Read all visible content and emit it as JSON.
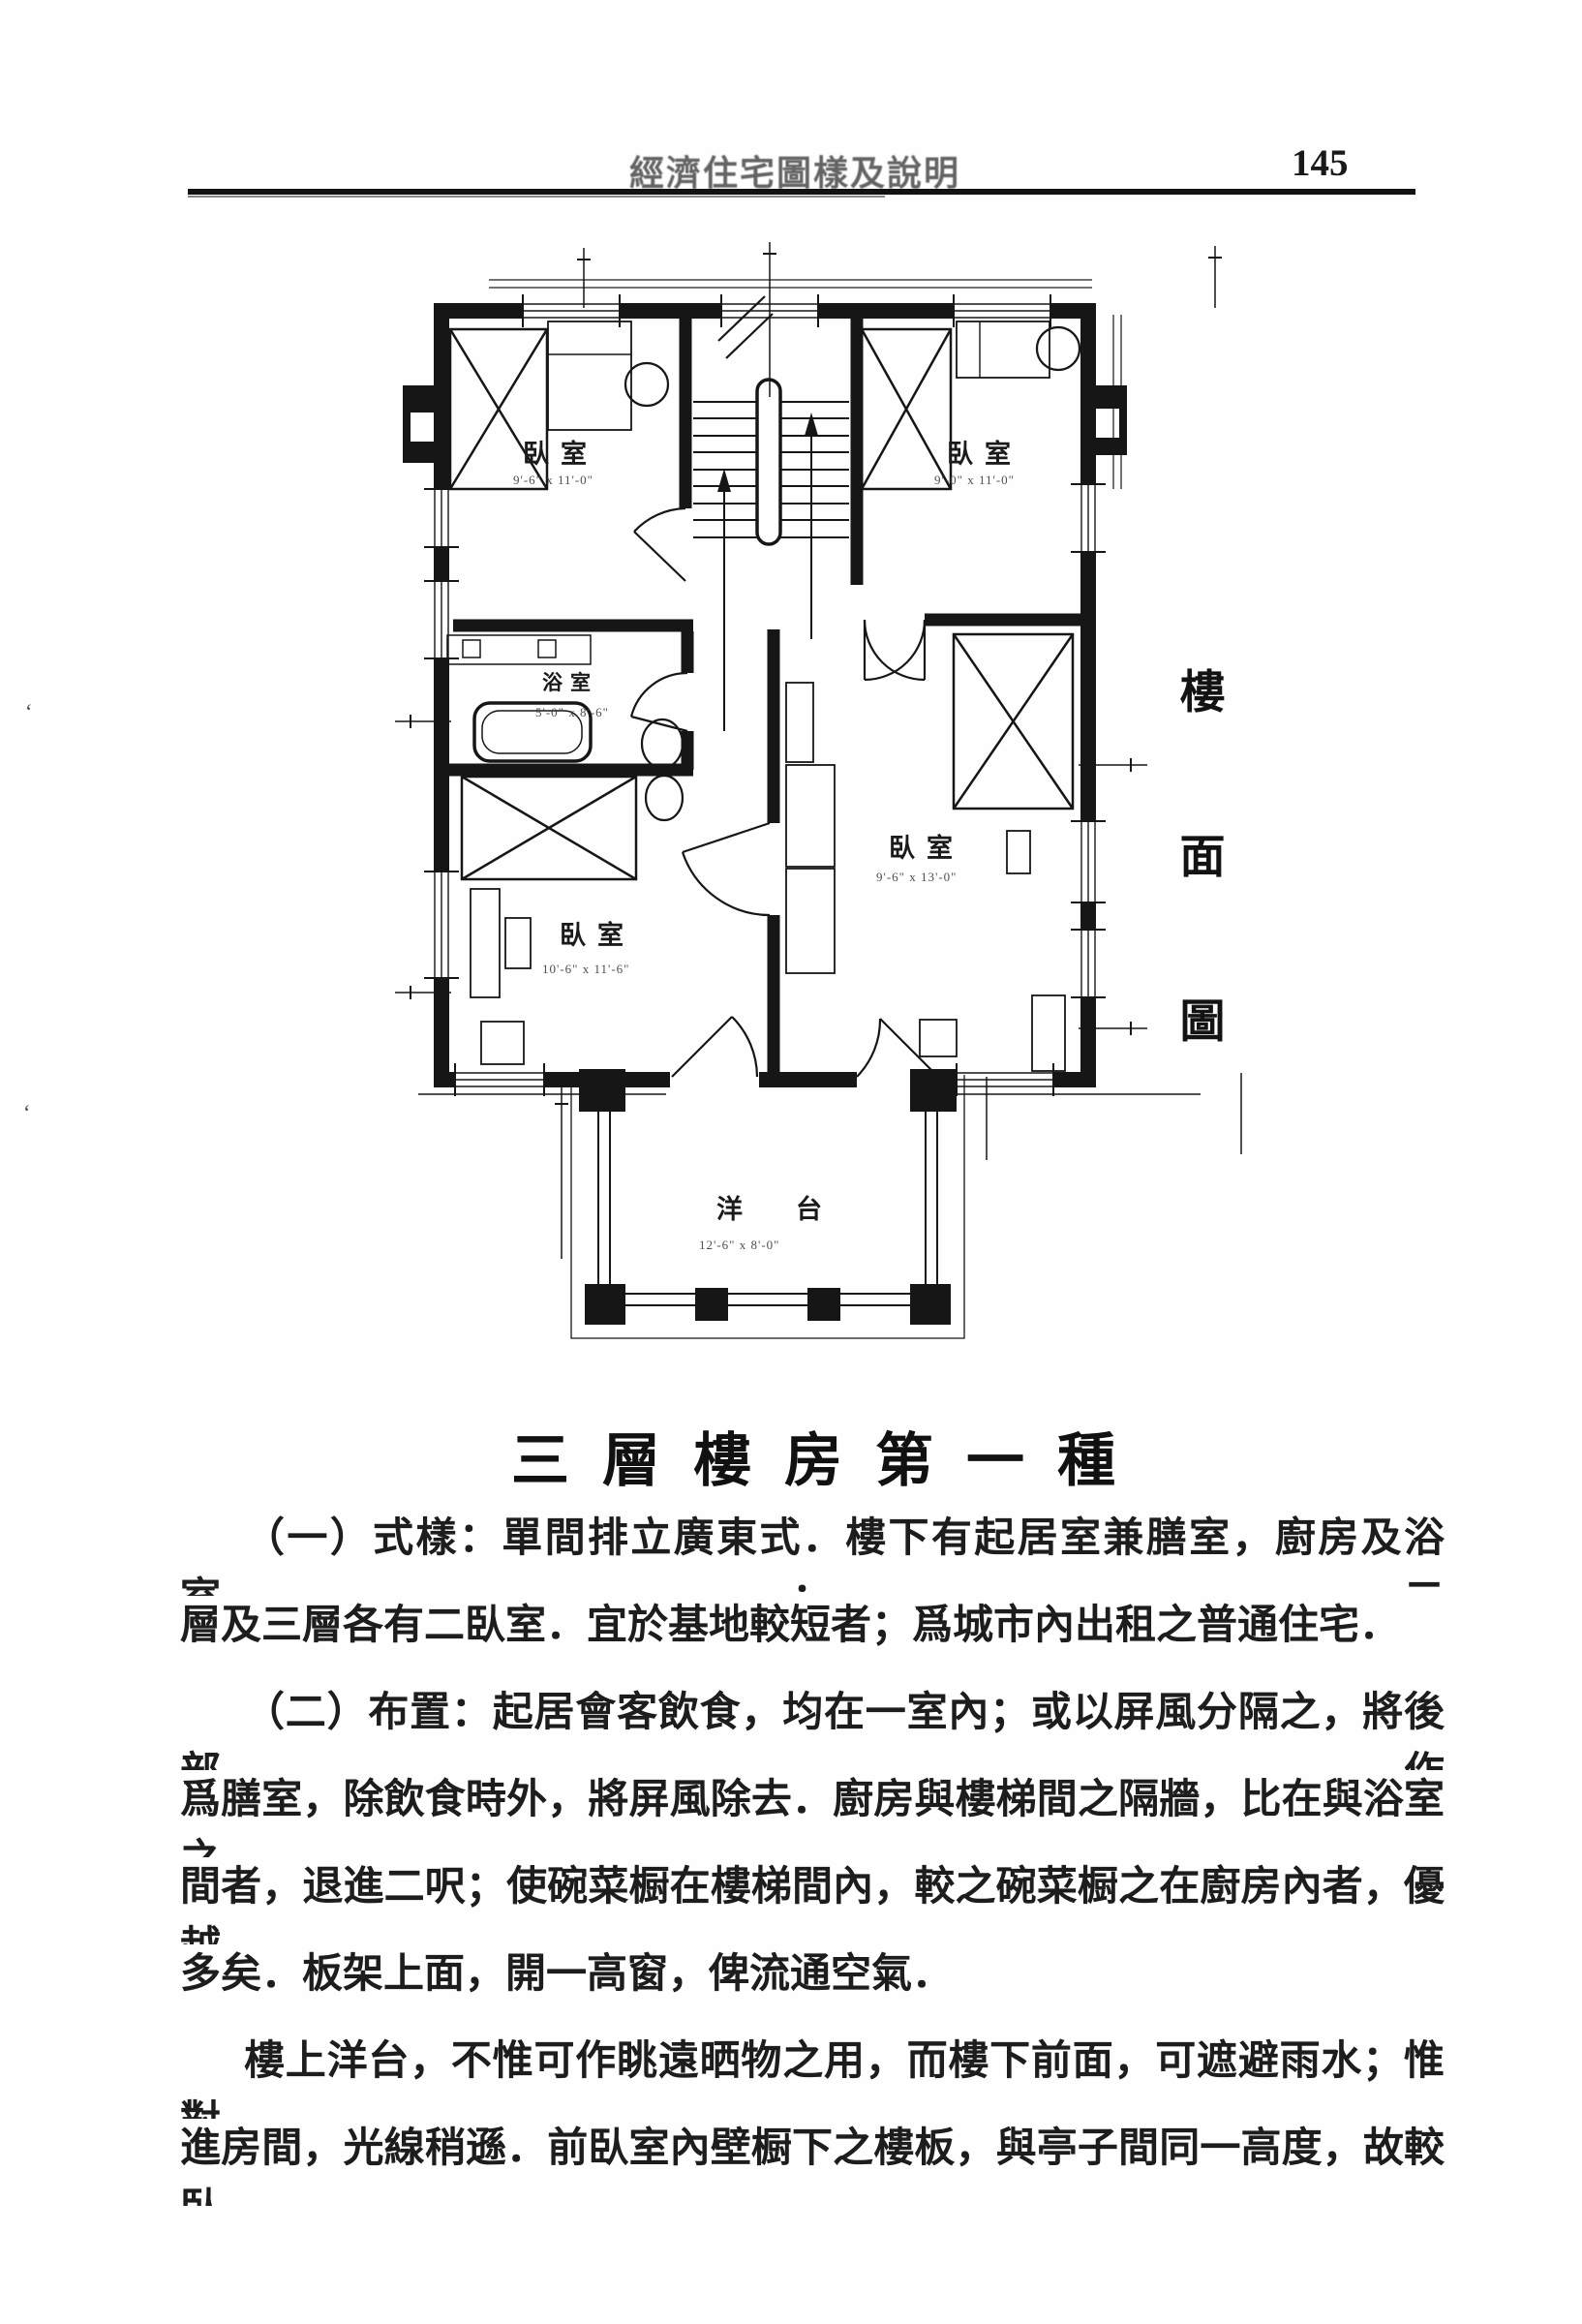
{
  "page": {
    "header_title": "經濟住宅圖樣及說明",
    "page_number": "145"
  },
  "side_caption": {
    "char1": "樓",
    "char2": "面",
    "char3": "圖"
  },
  "section_heading": "三層樓房第一種",
  "body": {
    "lines": [
      "（一）式樣：單間排立廣東式．樓下有起居室兼膳室，廚房及浴室；二",
      "層及三層各有二臥室．宜於基地較短者；爲城市內出租之普通住宅．",
      "（二）布置：起居會客飲食，均在一室內；或以屏風分隔之，將後部作",
      "爲膳室，除飲食時外，將屏風除去．廚房與樓梯間之隔牆，比在與浴室之",
      "間者，退進二呎；使碗菜橱在樓梯間內，較之碗菜橱之在廚房內者，優越",
      "多矣．板架上面，開一高窗，俾流通空氣．",
      "樓上洋台，不惟可作眺遠晒物之用，而樓下前面，可遮避雨水；惟對",
      "進房間，光線稍遜．前臥室內壁橱下之樓板，與亭子間同一高度，故較臥"
    ]
  },
  "plan": {
    "rooms": {
      "bedroom_top_left": {
        "label": "臥室",
        "dim": "9'-6\" x 11'-0\""
      },
      "bedroom_top_right": {
        "label": "臥室",
        "dim": "9'-0\" x 11'-0\""
      },
      "bathroom": {
        "label": "浴室",
        "dim": "5'-0\" x 8'-6\""
      },
      "bedroom_lower_left": {
        "label": "臥室",
        "dim": "10'-6\" x 11'-6\""
      },
      "bedroom_right": {
        "label": "臥室",
        "dim": "9'-6\" x 13'-0\""
      },
      "balcony": {
        "label": "洋台",
        "dim": "12'-6\" x 8'-0\""
      }
    }
  },
  "colors": {
    "ink": "#161616",
    "paper": "#fefefe",
    "faded_ink": "#4a4a4a"
  }
}
